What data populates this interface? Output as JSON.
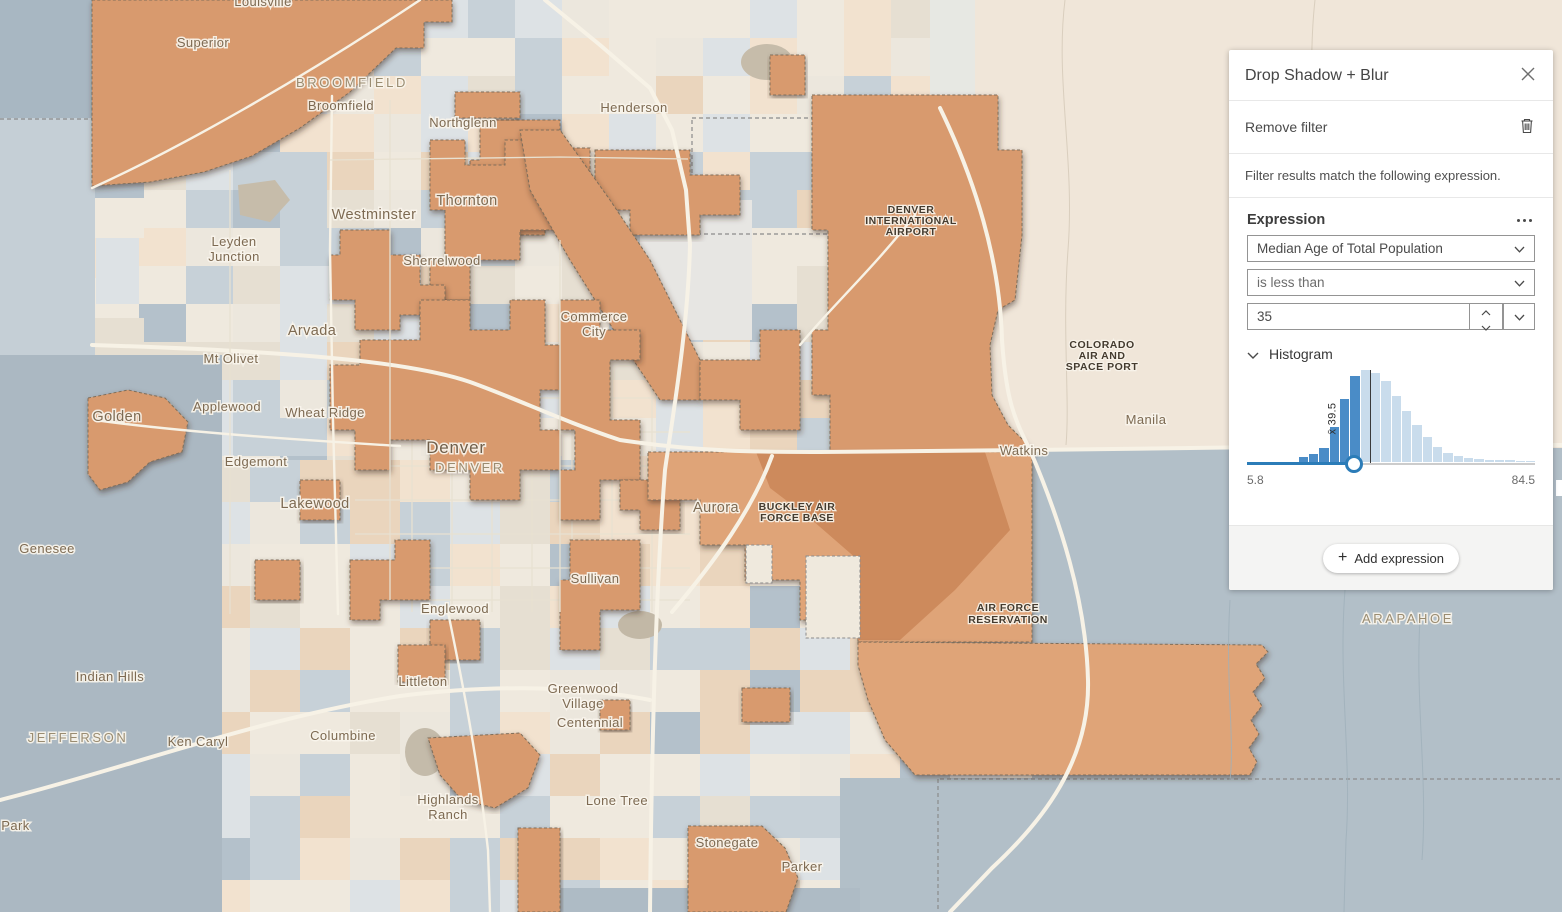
{
  "panel": {
    "title": "Drop Shadow + Blur",
    "remove_filter_label": "Remove filter",
    "description": "Filter results match the following expression.",
    "expression": {
      "heading": "Expression",
      "field_selected": "Median Age of Total Population",
      "operator_selected": "is less than",
      "value": "35"
    },
    "histogram_label": "Histogram",
    "add_expression_label": "Add expression"
  },
  "chart_data": {
    "type": "histogram",
    "title": "Median Age of Total Population distribution",
    "xmin": 5.8,
    "xmax": 84.5,
    "xmin_label": "5.8",
    "xmax_label": "84.5",
    "mean": 39.5,
    "mean_label": "x̄ 39.5",
    "slider_value": 35,
    "bins": [
      0,
      0,
      0,
      0,
      0,
      0.05,
      0.09,
      0.15,
      0.38,
      0.68,
      0.93,
      1,
      0.97,
      0.88,
      0.72,
      0.55,
      0.4,
      0.27,
      0.16,
      0.1,
      0.065,
      0.045,
      0.034,
      0.027,
      0.022,
      0.018,
      0.014,
      0.011
    ],
    "selected_color": "#4a8cc7",
    "unselected_color": "#c9dcec",
    "track_selected_color": "#2b7cb8",
    "track_color": "#cccccc",
    "legend": "dark bars = tracts matching filter (< 35), light bars = non-matching"
  },
  "map": {
    "colors": {
      "filtered_medium": "#d89a6e",
      "filtered_light": "#dfa478",
      "filtered_dark": "#cd8a5c",
      "blue_region": "#b2bfc8",
      "blue_left": "#abb8c2",
      "cream_topright": "#f0e6d9",
      "base_cream": "#ece7dd"
    },
    "labels": [
      {
        "t": "Louisville",
        "x": 263,
        "y": 6,
        "c": "city"
      },
      {
        "t": "Superior",
        "x": 203,
        "y": 47,
        "c": "city"
      },
      {
        "t": "BROOMFIELD",
        "x": 352,
        "y": 87,
        "c": "county"
      },
      {
        "t": "Broomfield",
        "x": 341,
        "y": 110,
        "c": "city"
      },
      {
        "t": "Northglenn",
        "x": 463,
        "y": 127,
        "c": "city"
      },
      {
        "t": "Henderson",
        "x": 634,
        "y": 112,
        "c": "city"
      },
      {
        "t": "Thornton",
        "x": 467,
        "y": 205,
        "c": "town"
      },
      {
        "t": "Westminster",
        "x": 374,
        "y": 219,
        "c": "town"
      },
      {
        "t": "Leyden",
        "x": 234,
        "y": 246,
        "c": "city"
      },
      {
        "t": "Junction",
        "x": 234,
        "y": 261,
        "c": "city"
      },
      {
        "t": "Sherrelwood",
        "x": 442,
        "y": 265,
        "c": "city"
      },
      {
        "t": "Commerce",
        "x": 594,
        "y": 321,
        "c": "city"
      },
      {
        "t": "City",
        "x": 594,
        "y": 336,
        "c": "city"
      },
      {
        "t": "Arvada",
        "x": 312,
        "y": 335,
        "c": "town"
      },
      {
        "t": "Mt Olivet",
        "x": 231,
        "y": 363,
        "c": "city"
      },
      {
        "t": "Applewood",
        "x": 227,
        "y": 411,
        "c": "city"
      },
      {
        "t": "Wheat Ridge",
        "x": 325,
        "y": 417,
        "c": "city"
      },
      {
        "t": "Golden",
        "x": 117,
        "y": 421,
        "c": "town"
      },
      {
        "t": "Edgemont",
        "x": 256,
        "y": 466,
        "c": "city"
      },
      {
        "t": "Denver",
        "x": 456,
        "y": 453,
        "c": "major"
      },
      {
        "t": "DENVER",
        "x": 470,
        "y": 472,
        "c": "county"
      },
      {
        "t": "Lakewood",
        "x": 315,
        "y": 508,
        "c": "town"
      },
      {
        "t": "Genesee",
        "x": 47,
        "y": 553,
        "c": "city"
      },
      {
        "t": "Aurora",
        "x": 716,
        "y": 512,
        "c": "town"
      },
      {
        "t": "BUCKLEY AIR",
        "x": 797,
        "y": 510,
        "c": "poi"
      },
      {
        "t": "FORCE BASE",
        "x": 797,
        "y": 521,
        "c": "poi"
      },
      {
        "t": "DENVER",
        "x": 911,
        "y": 213,
        "c": "poi"
      },
      {
        "t": "INTERNATIONAL",
        "x": 911,
        "y": 224,
        "c": "poi"
      },
      {
        "t": "AIRPORT",
        "x": 911,
        "y": 235,
        "c": "poi"
      },
      {
        "t": "COLORADO",
        "x": 1102,
        "y": 348,
        "c": "poi"
      },
      {
        "t": "AIR AND",
        "x": 1102,
        "y": 359,
        "c": "poi"
      },
      {
        "t": "SPACE PORT",
        "x": 1102,
        "y": 370,
        "c": "poi"
      },
      {
        "t": "Manila",
        "x": 1146,
        "y": 424,
        "c": "city"
      },
      {
        "t": "Watkins",
        "x": 1024,
        "y": 455,
        "c": "city"
      },
      {
        "t": "Sullivan",
        "x": 595,
        "y": 583,
        "c": "city"
      },
      {
        "t": "Englewood",
        "x": 455,
        "y": 613,
        "c": "city"
      },
      {
        "t": "AIR FORCE",
        "x": 1008,
        "y": 611,
        "c": "poi"
      },
      {
        "t": "RESERVATION",
        "x": 1008,
        "y": 623,
        "c": "poi"
      },
      {
        "t": "ARAPAHOE",
        "x": 1408,
        "y": 623,
        "c": "county"
      },
      {
        "t": "Indian Hills",
        "x": 110,
        "y": 681,
        "c": "city"
      },
      {
        "t": "Littleton",
        "x": 423,
        "y": 686,
        "c": "city"
      },
      {
        "t": "Greenwood",
        "x": 583,
        "y": 693,
        "c": "city"
      },
      {
        "t": "Village",
        "x": 583,
        "y": 708,
        "c": "city"
      },
      {
        "t": "Centennial",
        "x": 590,
        "y": 727,
        "c": "city"
      },
      {
        "t": "JEFFERSON",
        "x": 78,
        "y": 742,
        "c": "county"
      },
      {
        "t": "Ken Caryl",
        "x": 198,
        "y": 746,
        "c": "city"
      },
      {
        "t": "Columbine",
        "x": 343,
        "y": 740,
        "c": "city"
      },
      {
        "t": "Highlands",
        "x": 448,
        "y": 804,
        "c": "city"
      },
      {
        "t": "Ranch",
        "x": 448,
        "y": 819,
        "c": "city"
      },
      {
        "t": "Lone Tree",
        "x": 617,
        "y": 805,
        "c": "city"
      },
      {
        "t": "Stonegate",
        "x": 727,
        "y": 847,
        "c": "city"
      },
      {
        "t": "Parker",
        "x": 802,
        "y": 871,
        "c": "city"
      },
      {
        "t": "pen Park",
        "x": 2,
        "y": 830,
        "c": "city",
        "a": "start"
      }
    ]
  }
}
